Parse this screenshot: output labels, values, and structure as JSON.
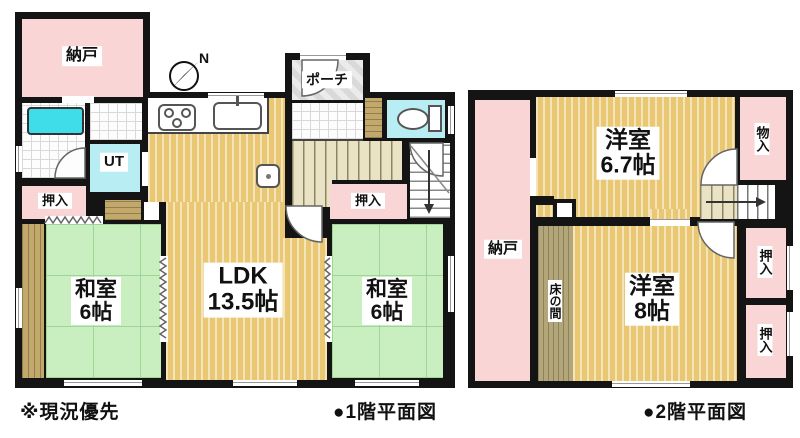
{
  "meta": {
    "type": "floor-plan",
    "floors": 2
  },
  "f1": {
    "caption": "●1階平面図",
    "note": "※現況優先",
    "compass": "N",
    "nando": "納戸",
    "porch": "ポーチ",
    "ut": "UT",
    "oshiire_left": "押入",
    "washitsu_left": {
      "name": "和室",
      "size": "6帖"
    },
    "ldk": {
      "name": "LDK",
      "size": "13.5帖"
    },
    "oshiire_right": "押入",
    "washitsu_right": {
      "name": "和室",
      "size": "6帖"
    }
  },
  "f2": {
    "caption": "●2階平面図",
    "nando": "納戸",
    "yoshitsu67": {
      "name": "洋室",
      "size": "6.7帖"
    },
    "monoire": "物入",
    "tokonoma": "床の間",
    "yoshitsu8": {
      "name": "洋室",
      "size": "8帖"
    },
    "oshiire_upper": "押入",
    "oshiire_lower": "押入"
  },
  "icons": [
    "compass-north",
    "stove",
    "kitchen-sink",
    "bathtub",
    "toilet",
    "washbasin",
    "stairs-down-arrow",
    "stairs-right-arrow",
    "door-swing-arc",
    "sliding-door-zigzag"
  ],
  "colors": {
    "wall": "#141414",
    "tatami": "#c9efc0",
    "wood": "#eac873",
    "closet_pink": "#f9d5d5",
    "water_cyan": "#b9edf4",
    "bathtub": "#3fdde9",
    "tokonoma": "#b3a678"
  }
}
